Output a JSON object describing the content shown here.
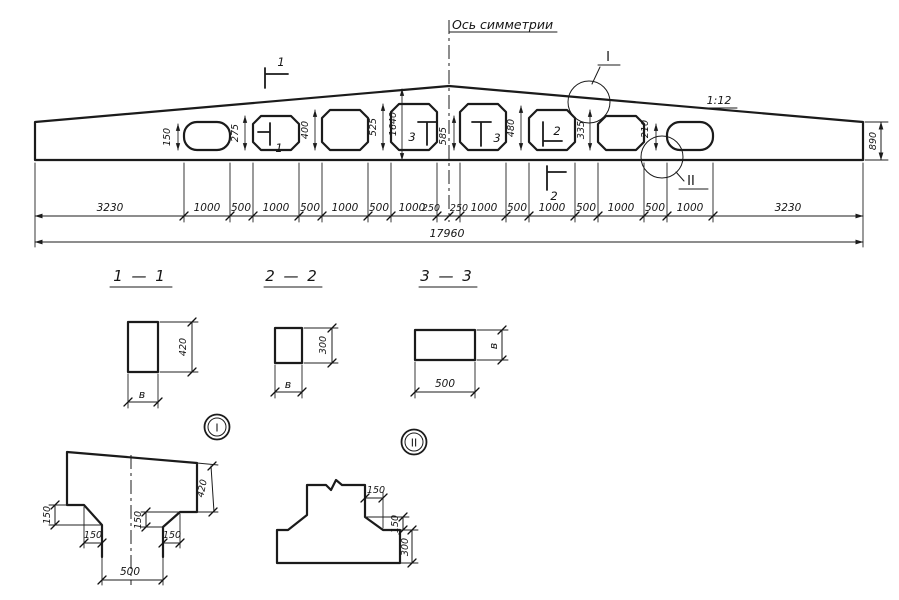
{
  "labels": {
    "axis": "Ось симметрии",
    "slope": "1:12"
  },
  "elevation": {
    "post_dims": [
      "150",
      "275",
      "400",
      "525",
      "1640",
      "585",
      "480",
      "335",
      "210"
    ],
    "end_height": "890",
    "chain": [
      "3230",
      "1000",
      "500",
      "1000",
      "500",
      "1000",
      "500",
      "1000",
      "250",
      "250",
      "1000",
      "500",
      "1000",
      "500",
      "1000",
      "500",
      "1000",
      "3230"
    ],
    "total": "17960",
    "cuts": {
      "c1_top": "1",
      "c1_in": "1",
      "c3_left": "3",
      "c3_right": "3",
      "c2_in": "2",
      "c2_below": "2"
    },
    "detail_refs": {
      "i": "I",
      "ii": "II"
    }
  },
  "sections": {
    "s11": {
      "title": "1 — 1",
      "h": "420",
      "w": "в"
    },
    "s22": {
      "title": "2 — 2",
      "h": "300",
      "w": "в"
    },
    "s33": {
      "title": "3 — 3",
      "w": "500",
      "h": "в"
    }
  },
  "details": {
    "i": {
      "badge": "I",
      "dims": [
        "150",
        "150",
        "150",
        "150"
      ],
      "depth": "420",
      "web": "500"
    },
    "ii": {
      "badge": "II",
      "dims": [
        "150",
        "150"
      ],
      "chord": "300"
    }
  }
}
